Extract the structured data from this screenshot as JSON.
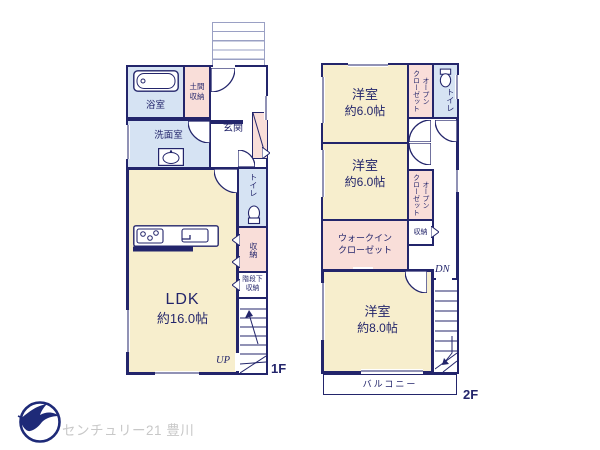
{
  "floor1": {
    "floor_label": "1F",
    "up_label": "UP",
    "bath_label": "浴室",
    "doma_storage_label": "土間\n収納",
    "entrance_label": "玄関",
    "washroom_label": "洗面室",
    "ldk_label": "LDK",
    "ldk_size": "約16.0帖",
    "toilet_label": "トイレ",
    "storage_label": "収納",
    "under_stairs_label": "階段下\n収納"
  },
  "floor2": {
    "floor_label": "2F",
    "down_label": "DN",
    "bedroom1_label": "洋室",
    "bedroom1_size": "約6.0帖",
    "open_closet1_label": "オープン\nクローゼット",
    "toilet_label": "トイレ",
    "bedroom2_label": "洋室",
    "bedroom2_size": "約6.0帖",
    "open_closet2_label": "オープン\nクローゼット",
    "walk_in_closet_label": "ウォークイン\nクローゼット",
    "storage_label": "収納",
    "bedroom3_label": "洋室",
    "bedroom3_size": "約8.0帖",
    "balcony_label": "バルコニー"
  },
  "logo": {
    "company": "センチュリー21 豊川"
  },
  "colors": {
    "wall": "#23256b",
    "room_cream": "#f7eecd",
    "wet_blue": "#d6e3f3",
    "closet_pink": "#f9ded9",
    "line_gray": "#9aa0c4",
    "logo_navy": "#1e2a78",
    "logo_text_gray": "#c8c8c8"
  }
}
